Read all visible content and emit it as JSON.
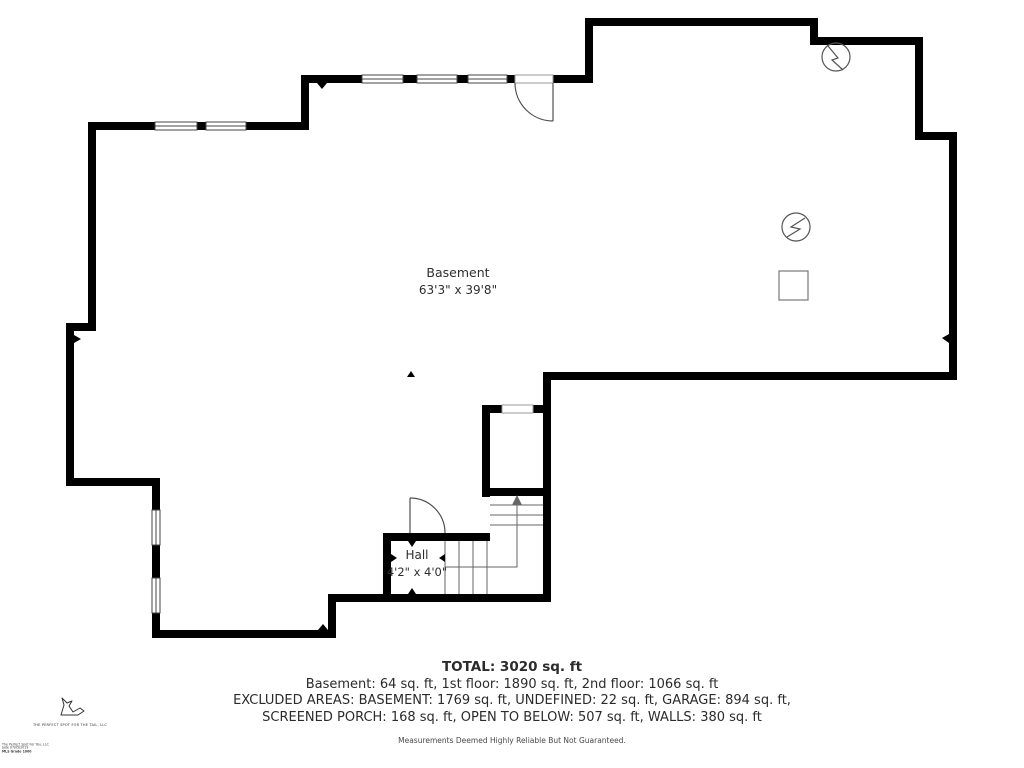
{
  "floorplan": {
    "rooms": [
      {
        "name": "Basement",
        "dimensions": "63'3\" x 39'8\""
      },
      {
        "name": "Hall",
        "dimensions": "4'2\" x 4'0\""
      }
    ],
    "summary": {
      "total": "TOTAL: 3020 sq. ft",
      "floors": "Basement: 64 sq. ft, 1st floor: 1890 sq. ft, 2nd floor: 1066 sq. ft",
      "excluded_line1": "EXCLUDED AREAS: BASEMENT: 1769 sq. ft, UNDEFINED: 22 sq. ft, GARAGE: 894 sq. ft,",
      "excluded_line2": "SCREENED PORCH: 168 sq. ft, OPEN TO BELOW: 507 sq. ft, WALLS: 380 sq. ft",
      "disclaimer": "Measurements Deemed Highly Reliable But Not Guaranteed."
    },
    "branding": {
      "logo_icon": "dog-icon",
      "logo_text": "THE PERFECT SPOT FOR THE TAIL, LLC",
      "fine_print": [
        "The Perfect Spot For You, LLC",
        "Jade 07/05/2019",
        "MLS Grade 1000"
      ]
    },
    "symbols": [
      "electrical-outlet-symbol",
      "electrical-outlet-symbol",
      "fixture-square-symbol",
      "stair-direction-arrow"
    ],
    "colors": {
      "wall": "#000000",
      "thin_line": "#555555",
      "text": "#2b2b2b"
    }
  }
}
